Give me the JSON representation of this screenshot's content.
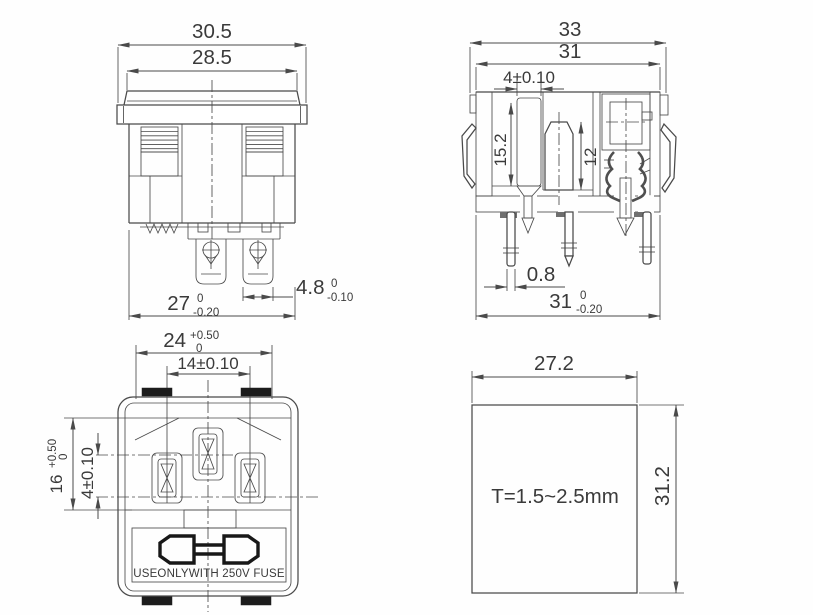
{
  "drawing": {
    "background": "#fefefe",
    "line_color": "#4a4a4a",
    "text_color": "#3a3a3a",
    "views": {
      "front_view": {
        "dim_overall_width": "30.5",
        "dim_cap_width": "28.5",
        "dim_body_width": "27",
        "dim_body_width_tol_upper": "0",
        "dim_body_width_tol_lower": "-0.20",
        "dim_terminal_width": "4.8",
        "dim_terminal_width_tol_upper": "0",
        "dim_terminal_width_tol_lower": "-0.10"
      },
      "side_section_view": {
        "dim_overall_width": "33",
        "dim_flange_width_top": "31",
        "dim_earth_pin_width": "4±0.10",
        "dim_earth_pin_depth": "15.2",
        "dim_cavity_depth": "12",
        "dim_solder_pin_thickness": "0.8",
        "dim_flange_width_bottom": "31",
        "dim_flange_width_bottom_tol_upper": "0",
        "dim_flange_width_bottom_tol_lower": "-0.20"
      },
      "face_view": {
        "dim_opening_width": "24",
        "dim_opening_width_tol_upper": "+0.50",
        "dim_opening_width_tol_lower": "0",
        "dim_pin_spacing": "14±0.10",
        "dim_opening_height": "16",
        "dim_opening_height_tol_upper": "+0.50",
        "dim_opening_height_tol_lower": "0",
        "dim_earth_pin_offset": "4±0.10",
        "fuse_warning_label": "USEONLYWITH 250V FUSE"
      },
      "panel_cutout_view": {
        "dim_cutout_width": "27.2",
        "dim_cutout_height": "31.2",
        "panel_thickness_note": "T=1.5~2.5mm"
      }
    }
  }
}
